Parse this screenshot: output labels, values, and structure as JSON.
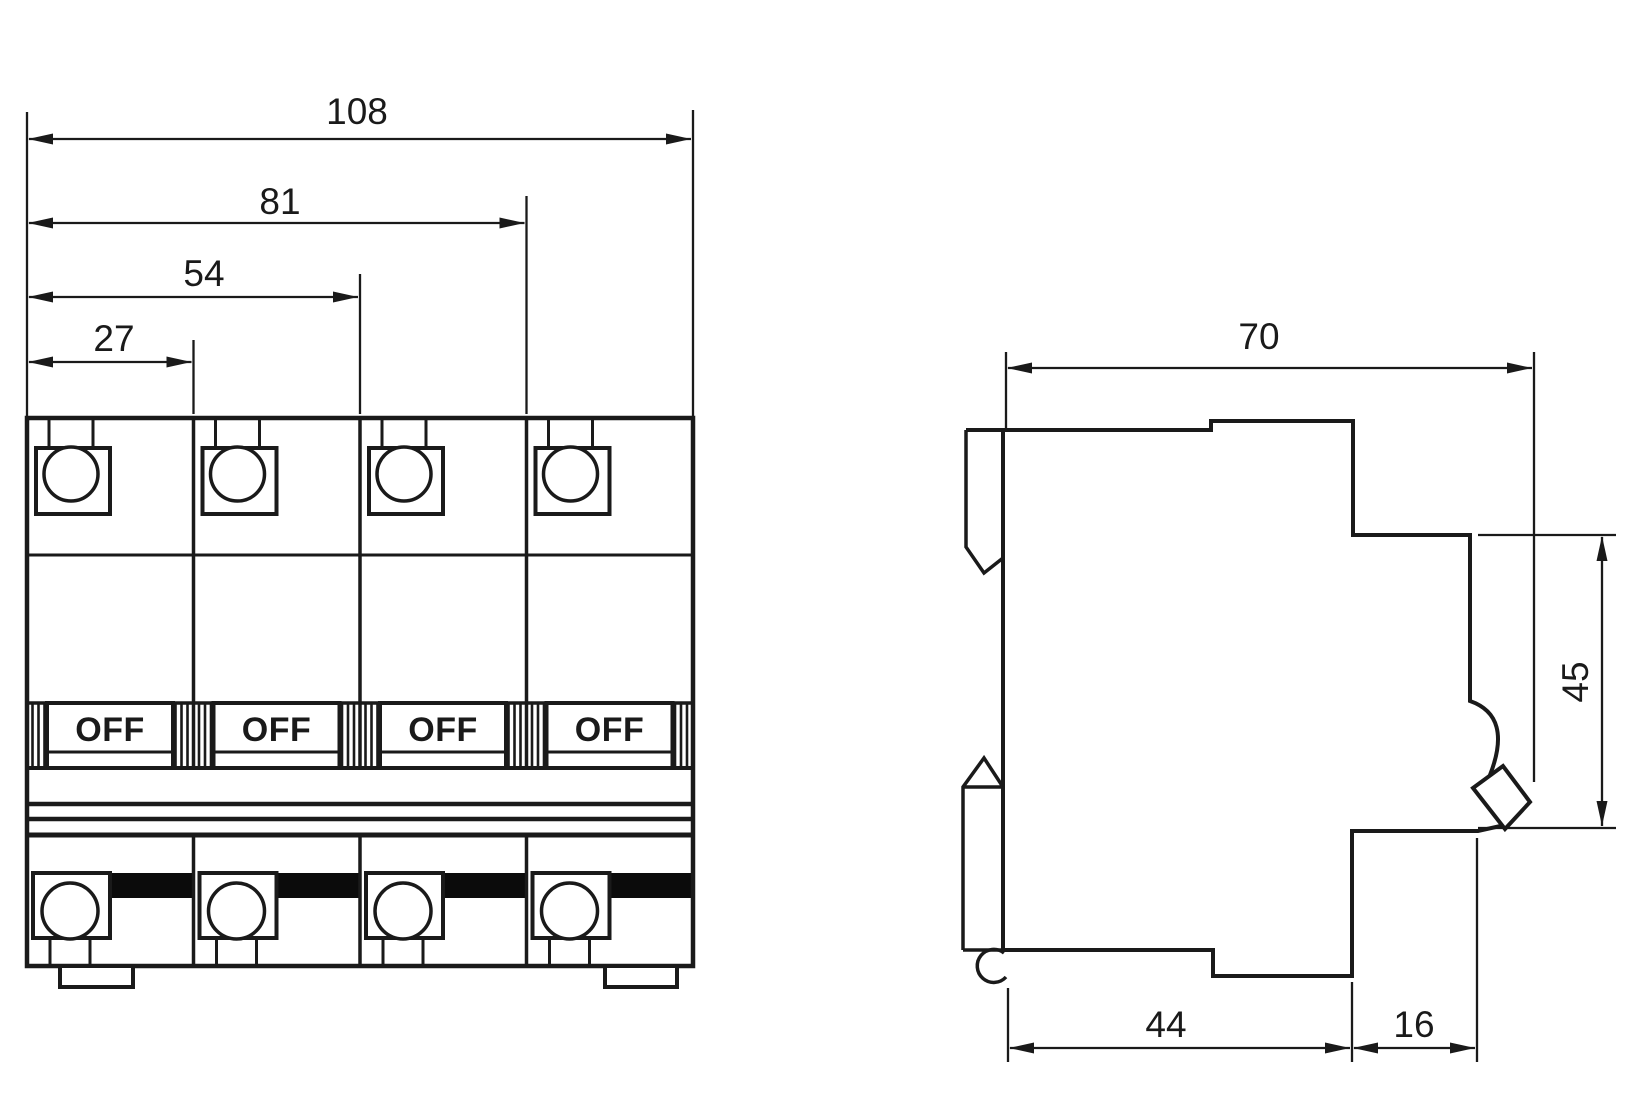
{
  "diagram": {
    "kind": "Dimensional drawing - 4-pole DIN-rail circuit breaker",
    "front_view": {
      "dims": {
        "overall_width": "108",
        "three_modules": "81",
        "two_modules": "54",
        "one_module": "27"
      },
      "pole_labels": [
        "OFF",
        "OFF",
        "OFF",
        "OFF"
      ]
    },
    "side_view": {
      "dims": {
        "overall_depth": "70",
        "face_height": "45",
        "base_depth": "44",
        "face_depth": "16"
      }
    },
    "colors": {
      "line": "#1a1a1a",
      "background": "#ffffff",
      "busbar_band": "#0b0b0b"
    }
  }
}
